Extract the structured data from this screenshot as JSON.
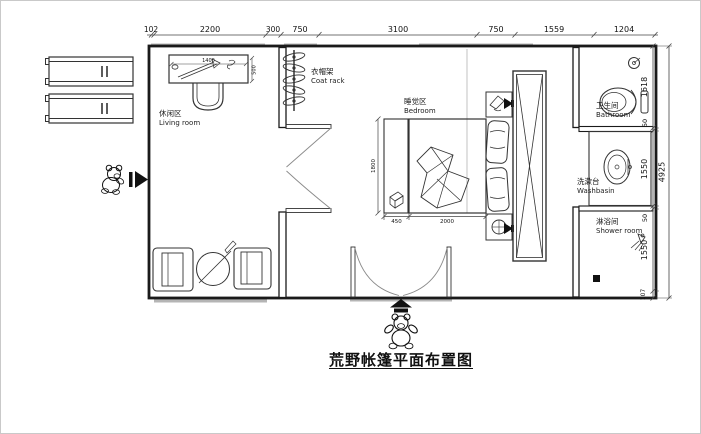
{
  "title": "荒野帐篷平面布置图",
  "rooms": {
    "living": {
      "zh": "休闲区",
      "en": "Living room"
    },
    "bedroom": {
      "zh": "睡觉区",
      "en": "Bedroom"
    },
    "bathroom": {
      "zh": "卫生间",
      "en": "Bathroom"
    },
    "washbasin": {
      "zh": "洗漱台",
      "en": "Washbasin"
    },
    "shower": {
      "zh": "淋浴间",
      "en": "Shower room"
    },
    "coat_rack": {
      "zh": "衣帽架",
      "en": "Coat rack"
    }
  },
  "dimensions": {
    "top": [
      "102",
      "2200",
      "300",
      "750",
      "3100",
      "750",
      "1559",
      "1204"
    ],
    "right": [
      "1618",
      "50",
      "1550",
      "50",
      "1550",
      "107"
    ],
    "right_total": "4925",
    "bed_length": "2000",
    "bed_width": "1800",
    "nightstand_width": "450",
    "desk_length": "1400",
    "desk_depth": "500"
  },
  "colors": {
    "line": "#1a1a1a",
    "window": "#b5b5b5"
  }
}
